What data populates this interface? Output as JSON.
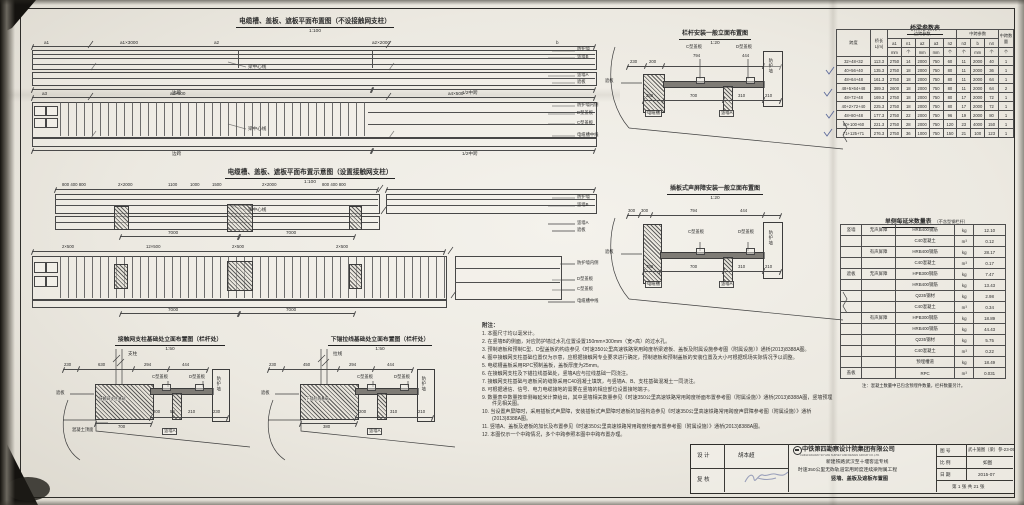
{
  "plan1": {
    "title": "电缆槽、盖板、遮板平面布置图（不设接触网支柱）",
    "scale": "1:100",
    "dims_top": [
      "a1",
      "a1×3000",
      "a2",
      "a2×2000",
      "b"
    ],
    "dims_mid": [
      "a3",
      "a3×500",
      "a4×500"
    ],
    "centerline": "梁中心线",
    "side_span": "边跨",
    "half_mid_span": "1/2中跨",
    "side_labels_upper": [
      "防护墙",
      "竖墙B",
      "竖墙A",
      "遮板"
    ],
    "side_labels_lower": [
      "防护墙内侧",
      "D型盖板",
      "C型盖板",
      "电缆槽中线"
    ]
  },
  "plan2": {
    "title": "电缆槽、盖板、遮板平面布置示意图（设置接触网支柱）",
    "scale": "1:100",
    "dims_top": [
      "800 400 800",
      "2×2000",
      "1100",
      "1000",
      "1500",
      "2×2000",
      "800 400 800"
    ],
    "dims_total": [
      "7000",
      "7000"
    ],
    "dims_mid": [
      "2×500",
      "12×500",
      "2×500",
      "2×500"
    ],
    "dims_total2": [
      "7000",
      "7000"
    ],
    "centerline": "梁中心线",
    "side_labels_upper": [
      "防护墙",
      "竖墙B",
      "竖墙A",
      "遮板"
    ],
    "side_labels_lower": [
      "防护墙内侧",
      "D型盖板",
      "C型盖板",
      "电缆槽中线"
    ]
  },
  "elev1": {
    "title": "栏杆安装一般立面布置图",
    "scale": "1:20",
    "dims_top": [
      "230",
      "200",
      "794",
      "444"
    ],
    "label_c": "C型盖板",
    "label_d": "D型盖板",
    "label_wall": "防护墙",
    "label_zheban": "遮板",
    "dims_inner": [
      "250",
      "700",
      "310",
      "210"
    ],
    "label_cable": "电缆槽",
    "label_wall_a": "竖墙A"
  },
  "elev2": {
    "title": "插板式声屏障安装一般立面布置图",
    "scale": "1:20",
    "dims_top": [
      "300",
      "300",
      "794",
      "444"
    ],
    "label_c": "C型盖板",
    "label_d": "D型盖板",
    "label_wall": "防护墙",
    "label_zheban": "遮板",
    "dims_inner": [
      "750",
      "700",
      "310",
      "210"
    ],
    "label_cable": "电缆槽",
    "label_wall_a": "竖墙A"
  },
  "section_a": {
    "title": "接触网支柱基础处立面布置图（栏杆处）",
    "scale": "1:50",
    "label_pole": "支柱",
    "dims_top": [
      "230",
      "630",
      "294",
      "444"
    ],
    "label_foundation": "接触网支柱基础",
    "dim_foundation": "700",
    "dims_bottom": [
      "200",
      "50",
      "210",
      "230"
    ],
    "label_c": "C型盖板",
    "label_d": "D型盖板",
    "label_wall": "防护墙",
    "label_zheban": "遮板",
    "label_wall_a": "竖墙A",
    "label_surface": "混凝土顶面"
  },
  "section_b": {
    "title": "下锚拉线基础处立面布置图（栏杆处）",
    "scale": "1:50",
    "label_pole": "拉线",
    "dims_top": [
      "230",
      "450",
      "294",
      "444"
    ],
    "label_foundation": "下锚拉线基础",
    "dim_foundation": "380",
    "dims_bottom": [
      "200",
      "310",
      "210"
    ],
    "label_c": "C型盖板",
    "label_d": "D型盖板",
    "label_wall": "防护墙",
    "label_zheban": "遮板",
    "label_wall_a": "竖墙A"
  },
  "bridge_table": {
    "title": "桥梁参数表",
    "col_span": "跨度",
    "col_length": "桥长L(m)",
    "group_side": "边跨参数",
    "group_mid": "中跨参数",
    "col_mid_count": "中跨数量",
    "sub_headers": [
      "a1",
      "n1",
      "a2",
      "a3",
      "n2",
      "n3",
      "b",
      "n4"
    ],
    "units": [
      "mm",
      "个",
      "mm",
      "mm",
      "个",
      "个",
      "mm",
      "个",
      "个"
    ],
    "rows": [
      [
        "32+48+32",
        "113.3",
        "2750",
        "14",
        "2000",
        "750",
        "60",
        "11",
        "2000",
        "40",
        "1"
      ],
      [
        "40+56+40",
        "135.3",
        "2750",
        "18",
        "2000",
        "750",
        "80",
        "11",
        "2000",
        "36",
        "1"
      ],
      [
        "48+64+48",
        "161.3",
        "2750",
        "18",
        "2000",
        "750",
        "80",
        "11",
        "2000",
        "64",
        "1"
      ],
      [
        "48+5×64+48",
        "389.3",
        "2600",
        "18",
        "2000",
        "750",
        "80",
        "11",
        "2000",
        "64",
        "2"
      ],
      [
        "48+72+48",
        "169.3",
        "2750",
        "18",
        "2000",
        "750",
        "80",
        "17",
        "2000",
        "72",
        "1"
      ],
      [
        "40+2×72+40",
        "225.3",
        "2750",
        "18",
        "2000",
        "750",
        "80",
        "17",
        "2000",
        "72",
        "1"
      ],
      [
        "48+80+48",
        "177.3",
        "2750",
        "22",
        "2000",
        "750",
        "96",
        "19",
        "2000",
        "80",
        "1"
      ],
      [
        "60+100+60",
        "221.3",
        "2750",
        "28",
        "2000",
        "750",
        "120",
        "23",
        "4000",
        "150",
        "1"
      ],
      [
        "71+125+71",
        "276.3",
        "2750",
        "36",
        "1000",
        "750",
        "150",
        "21",
        "100",
        "123",
        "1"
      ]
    ]
  },
  "qty_table": {
    "title": "单侧每延米数量表",
    "subtitle": "（不含型钢栏杆）",
    "rows": [
      [
        "竖墙",
        "无声屏障",
        "HRB400钢筋",
        "kg",
        "12.10"
      ],
      [
        "",
        "",
        "C40混凝土",
        "m³",
        "0.12"
      ],
      [
        "",
        "有声屏障",
        "HRB400钢筋",
        "kg",
        "28.17"
      ],
      [
        "",
        "",
        "C40混凝土",
        "m³",
        "0.17"
      ],
      [
        "遮板",
        "无声屏障",
        "HPB300钢筋",
        "kg",
        "7.47"
      ],
      [
        "",
        "",
        "HRB400钢筋",
        "kg",
        "13.43"
      ],
      [
        "",
        "",
        "Q235钢材",
        "kg",
        "2.98"
      ],
      [
        "",
        "",
        "C40混凝土",
        "m³",
        "0.34"
      ],
      [
        "",
        "有声屏障",
        "HPB300钢筋",
        "kg",
        "18.89"
      ],
      [
        "",
        "",
        "HRB400钢筋",
        "kg",
        "44.43"
      ],
      [
        "",
        "",
        "Q235钢材",
        "kg",
        "5.75"
      ],
      [
        "",
        "",
        "C40混凝土",
        "m³",
        "0.22"
      ],
      [
        "",
        "",
        "预埋槽道",
        "kg",
        "18.49"
      ],
      [
        "盖板",
        "",
        "RPC",
        "m³",
        "0.031"
      ]
    ],
    "note": "注：混凝土数量中已包含预埋件数量，栏杆数量另计。"
  },
  "notes": {
    "heading": "附注：",
    "items": [
      "1. 本图尺寸均以毫米计。",
      "2. 在竖墙B的侧面，对应防护墙过水孔位置设置150mm×300mm（宽×高）的过水孔。",
      "3. 预制遮板和预制C型、D型盖板的构造参见《时速350公里高速铁路常用跨度桥梁遮板、盖板及附属设施参考图（附属设施）》通桥(2013)8388A图。",
      "4. 图中接触网支柱基础位置仅为示意，应根据接触网专业要求进行确定，预制遮板和预制盖板的安装位置及大小可根据现场实际情况予以调整。",
      "5. 电缆槽盖板采用RPC预制盖板，盖板厚度为25mm。",
      "6. 在接触网支柱及下锚拉线基础处，竖墙A应与拉线基础一同浇注。",
      "7. 接触网支柱基础与遮板间的缝隙采用C40混凝土填筑，与竖墙A、B、支柱基础混凝土一同浇注。",
      "8. 可根据通信、信号、电力电缆接地的需要在竖墙的相应部位设置接地端子。",
      "9. 数量表中数量按单侧每延米计算给出，其中竖墙相关数量参见《时速350公里高速铁路常用跨度桥面布置参考图（附属设施）》通桥(2013)8388A图，竖墙预埋件见相关图。",
      "10. 当设置声屏障时，采用插板式声屏障，安装插板式声屏障时遮板的加强构造参见《时速350公里高速铁路常用跨度声屏障参考图（附属设施）》通桥(2013)8388A图。",
      "11. 竖墙A、盖板及遮板的加长及布置参见《时速350公里高速铁路常用跨度桥面布置参考图（附属设施）》通桥(2013)8388A图。",
      "12. 本图仅示一个中跨情况，多个中跨参照本图中中跨布置办理。"
    ]
  },
  "titleblock": {
    "design_label": "设 计",
    "design_value": "胡本超",
    "check_label": "复 核",
    "company": "中铁第四勘察设计院集团有限公司",
    "company_en": "CHINA RAILWAY SIYUAN SURVEY AND DESIGN GROUP CO.,LTD.",
    "project_line1": "新建铁路武汉至十堰客运专线",
    "project_line2": "时速350公里无砟轨道常用跨度连续梁附属工程",
    "project_line3": "竖墙、盖板及遮板布置图",
    "figno_label": "图 号",
    "figno_value": "武十施图（梁）参-23-05",
    "scale_label": "比 例",
    "scale_value": "如图",
    "date_label": "日 期",
    "date_value": "2015-07",
    "sheet_info": "第 1 张 共 21 张"
  }
}
